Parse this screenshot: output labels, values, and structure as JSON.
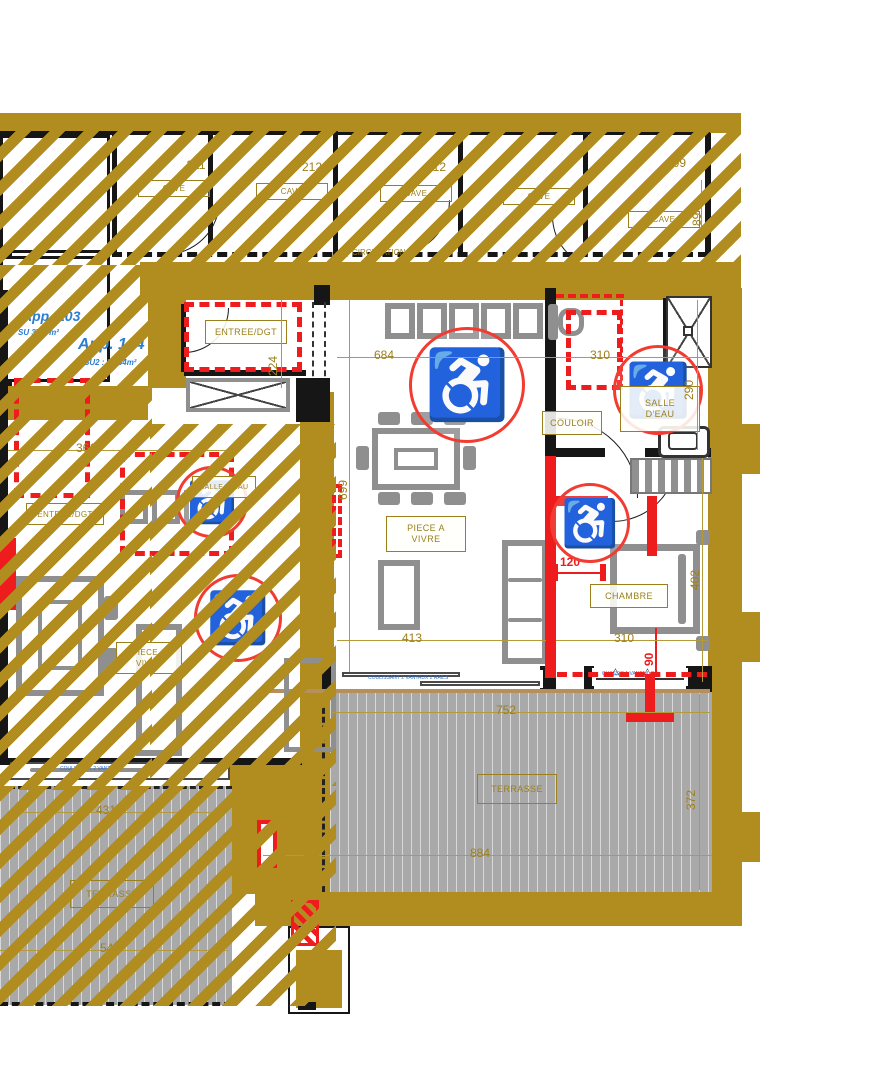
{
  "palette": {
    "gold": "#b08d1e",
    "red": "#ee1c1c",
    "furniture_gray": "#8f8f8f",
    "deck_gray": "#a9a9a9",
    "dim_gold": "#9c7f1d",
    "blue": "#2a7fd4"
  },
  "apartments": [
    {
      "name": "App. 103",
      "area": "SU 37.6 m²"
    },
    {
      "name": "App. 104",
      "area": "SU2 : 54.54m²"
    }
  ],
  "caves": {
    "circulation": "CIRCULATION",
    "stalls": [
      {
        "number": "211",
        "label": "CAVE"
      },
      {
        "number": "212",
        "label": "CAVE"
      },
      {
        "number": "212",
        "label": "CAVE"
      },
      {
        "number": "",
        "label": "CAVE"
      },
      {
        "number": "109",
        "label": "CAVE"
      }
    ]
  },
  "rooms": {
    "entree": "ENTREE/DGT",
    "living1": "PIECE A",
    "living2": "VIVRE",
    "couloir": "COULOIR",
    "salle1": "SALLE",
    "salle2": "D'EAU",
    "chambre": "CHAMBRE",
    "terrasse": "TERRASSE",
    "entree_left": "ENTREE/DGT",
    "living_left1": "PIECE A",
    "living_left2": "VIVRE",
    "salle_left": "SALLE D'EAU",
    "terrasse_left": "TERRASSE"
  },
  "dims": {
    "d684": "684",
    "d699": "699",
    "d224": "224",
    "d413": "413",
    "d310_salle": "310",
    "d310_chambre": "310",
    "d290": "290",
    "d402": "402",
    "d120": "120",
    "d90": "90",
    "d89": "89",
    "d752": "752",
    "d884": "884",
    "d372": "372",
    "d361": "361",
    "d431": "431",
    "d549": "549"
  },
  "notes": {
    "window_living": "COULISSANT 2 VANTAUX 2 RAILS",
    "window_chambre": "CHASSIS 1 VANTAIL OF",
    "window_left": "COULISSANT 2 VANTAUX"
  },
  "icons": {
    "wheelchair": "♿",
    "window_marker": "△"
  }
}
